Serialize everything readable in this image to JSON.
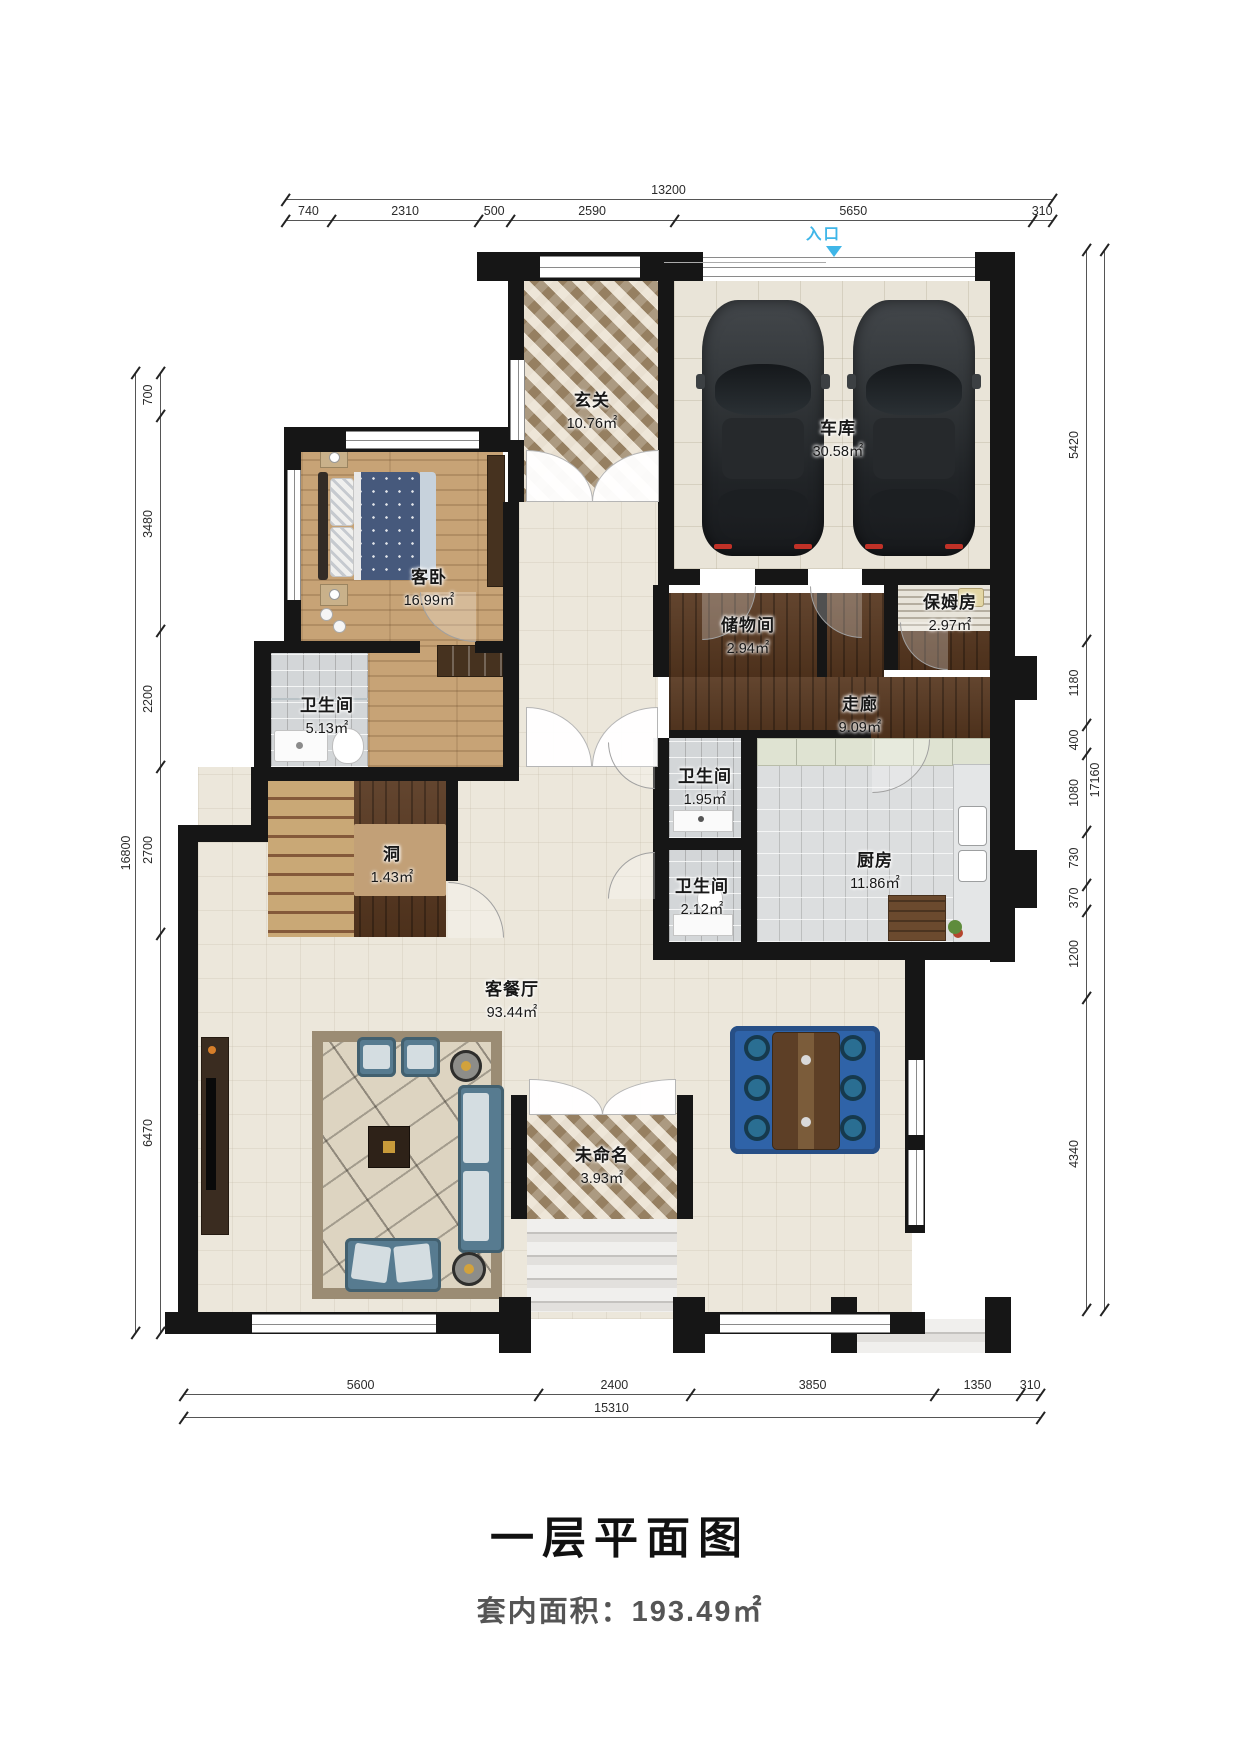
{
  "title": "一层平面图",
  "area_summary": "套内面积：193.49㎡",
  "entrance": {
    "label": "入口"
  },
  "rooms": {
    "entry": {
      "name": "玄关",
      "area": "10.76㎡"
    },
    "garage": {
      "name": "车库",
      "area": "30.58㎡"
    },
    "guest_bedroom": {
      "name": "客卧",
      "area": "16.99㎡"
    },
    "bath_main": {
      "name": "卫生间",
      "area": "5.13㎡"
    },
    "storage": {
      "name": "储物间",
      "area": "2.94㎡"
    },
    "nanny_room": {
      "name": "保姆房",
      "area": "2.97㎡"
    },
    "corridor": {
      "name": "走廊",
      "area": "9.09㎡"
    },
    "bath_small": {
      "name": "卫生间",
      "area": "1.95㎡"
    },
    "bath_mid": {
      "name": "卫生间",
      "area": "2.12㎡"
    },
    "kitchen": {
      "name": "厨房",
      "area": "11.86㎡"
    },
    "stair_void": {
      "name": "洞",
      "area": "1.43㎡"
    },
    "living_dining": {
      "name": "客餐厅",
      "area": "93.44㎡"
    },
    "unnamed": {
      "name": "未命名",
      "area": "3.93㎡"
    }
  },
  "dimensions": {
    "top": {
      "total": "13200",
      "segments": [
        {
          "label": "740",
          "v": 740
        },
        {
          "label": "2310",
          "v": 2310
        },
        {
          "label": "500",
          "v": 500
        },
        {
          "label": "2590",
          "v": 2590
        },
        {
          "label": "5650",
          "v": 5650
        },
        {
          "label": "310",
          "v": 310
        }
      ]
    },
    "bottom": {
      "total": "15310",
      "segments": [
        {
          "label": "5600",
          "v": 5600
        },
        {
          "label": "2400",
          "v": 2400
        },
        {
          "label": "3850",
          "v": 3850
        },
        {
          "label": "1350",
          "v": 1350
        },
        {
          "label": "310",
          "v": 310
        }
      ]
    },
    "left": {
      "total": "16800",
      "segments": [
        {
          "label": "700",
          "v": 700
        },
        {
          "label": "3480",
          "v": 3480
        },
        {
          "label": "2200",
          "v": 2200
        },
        {
          "label": "2700",
          "v": 2700
        },
        {
          "label": "6470",
          "v": 6470
        }
      ]
    },
    "right": {
      "total": "17160",
      "segments": [
        {
          "label": "5420",
          "v": 5420
        },
        {
          "label": "1180",
          "v": 1180
        },
        {
          "label": "400",
          "v": 400
        },
        {
          "label": "1080",
          "v": 1080
        },
        {
          "label": "730",
          "v": 730
        },
        {
          "label": "370",
          "v": 370
        },
        {
          "label": "1200",
          "v": 1200
        },
        {
          "label": "4340",
          "v": 4340
        }
      ]
    }
  },
  "colors": {
    "wall": "#161616",
    "entrance_accent": "#3fb6e8",
    "dim_line": "#555555"
  }
}
